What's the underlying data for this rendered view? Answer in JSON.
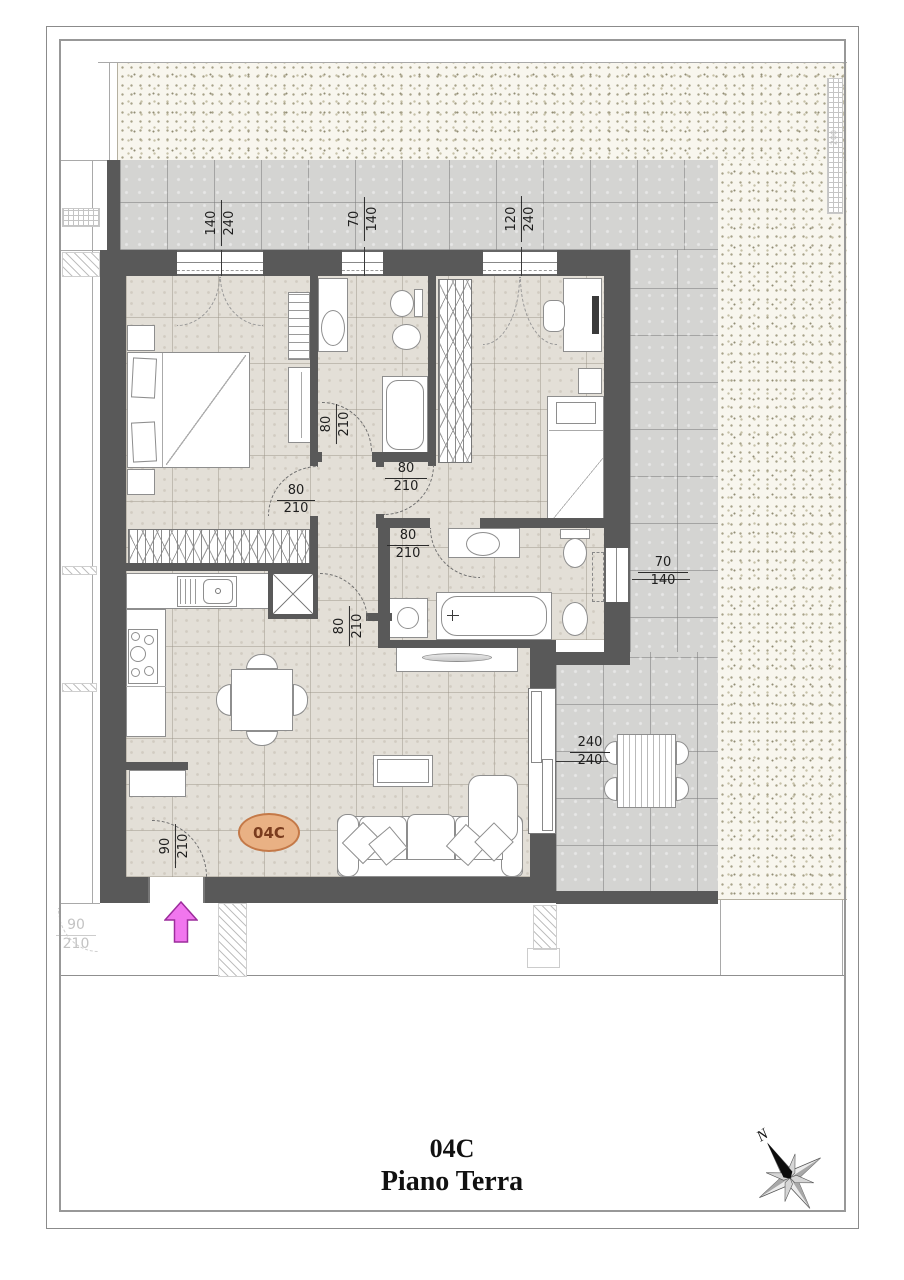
{
  "page": {
    "title_unit": "04C",
    "title_floor": "Piano Terra"
  },
  "plan": {
    "unit_badge": "04C"
  },
  "compass": {
    "north": "N"
  },
  "dims": {
    "win_master": {
      "w": "140",
      "h": "240"
    },
    "win_bath1": {
      "w": "70",
      "h": "140"
    },
    "win_bed2": {
      "w": "120",
      "h": "240"
    },
    "win_bath2": {
      "w": "70",
      "h": "140"
    },
    "door_patio": {
      "w": "240",
      "h": "240"
    },
    "door_master": {
      "w": "80",
      "h": "210"
    },
    "door_bath1": {
      "w": "80",
      "h": "210"
    },
    "door_bed2": {
      "w": "80",
      "h": "210"
    },
    "door_bath2": {
      "w": "80",
      "h": "210"
    },
    "door_living": {
      "w": "80",
      "h": "210"
    },
    "door_entry": {
      "w": "90",
      "h": "210"
    },
    "door_neighbor": {
      "w": "90",
      "h": "210"
    },
    "fence": {
      "w": "200"
    }
  },
  "colors": {
    "wall": "#595959",
    "badge_fill": "#e9b184",
    "arrow": "#f176ee"
  }
}
